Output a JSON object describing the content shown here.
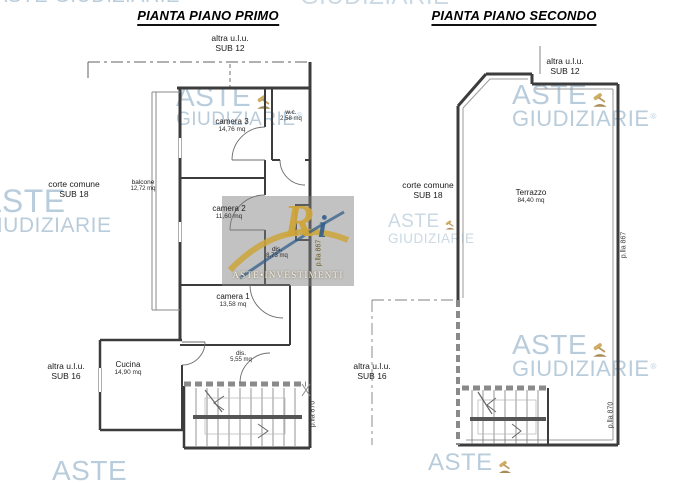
{
  "watermark": {
    "word1": "ASTE",
    "word2": "GIUDIZIARIE",
    "registered": "®",
    "brand_color": "#8eadc5",
    "gavel_color": "#c3993f"
  },
  "center_logo": {
    "monogram_r": "R",
    "monogram_i": "i",
    "caption": "ASTE•INVESTIMENTI",
    "gold_color": "#cda43a",
    "blue_color": "#315d8a"
  },
  "plans": [
    {
      "title": "PIANTA PIANO PRIMO",
      "adjacent_top": {
        "line1": "altra u.l.u.",
        "line2": "SUB 12"
      },
      "adjacent_left": {
        "line1": "corte comune",
        "line2": "SUB 18"
      },
      "adjacent_bottom_left": {
        "line1": "altra u.l.u.",
        "line2": "SUB 16"
      },
      "parcel_right": "p.lla 867",
      "parcel_bottom": "p.lla 870",
      "rooms": [
        {
          "name": "camera 3",
          "area": "14,76 mq"
        },
        {
          "name": "w.c.",
          "area": "2,58 mq"
        },
        {
          "name": "balcone",
          "area": "12,72 mq"
        },
        {
          "name": "camera 2",
          "area": "11,60 mq"
        },
        {
          "name": "dis.",
          "area": "8,73 mq"
        },
        {
          "name": "camera 1",
          "area": "13,58 mq"
        },
        {
          "name": "dis.",
          "area": "5,55 mq"
        },
        {
          "name": "Cucina",
          "area": "14,90 mq"
        }
      ]
    },
    {
      "title": "PIANTA PIANO SECONDO",
      "adjacent_top": {
        "line1": "altra u.l.u.",
        "line2": "SUB 12"
      },
      "adjacent_left": {
        "line1": "corte comune",
        "line2": "SUB 18"
      },
      "adjacent_bottom_left": {
        "line1": "altra u.l.u.",
        "line2": "SUB 16"
      },
      "parcel_right": "p.lla 867",
      "parcel_bottom": "p.lla 870",
      "rooms": [
        {
          "name": "Terrazzo",
          "area": "84,40 mq"
        }
      ]
    }
  ]
}
